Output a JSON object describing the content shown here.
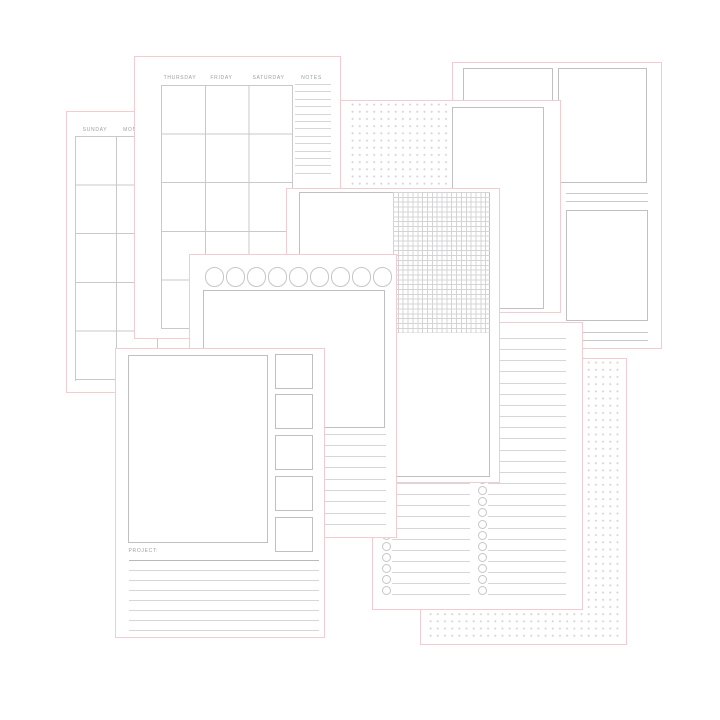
{
  "colors": {
    "pink": "#f4cbd1",
    "grid": "#c9c9cd",
    "gridlite": "#d4d4d7",
    "box": "#bfbfc4",
    "rule": "#d6d6d9",
    "ruleDark": "#b9b9bd",
    "text": "#9ca0a5",
    "dot": "#d8d3d5",
    "circle": "#c6c6ca"
  },
  "sheets": {
    "sunday_month": {
      "day_headers": [
        "SUNDAY",
        "MONDAY"
      ],
      "row_count": 5
    },
    "weekday_month": {
      "day_headers": [
        "THURSDAY",
        "FRIDAY",
        "SATURDAY"
      ],
      "notes_header": "NOTES",
      "notes_line_count": 13,
      "row_count": 5
    },
    "boxes_notes": {
      "box_count": 3,
      "divider_line_count": 2
    },
    "dot_grid_top": {
      "dot_pitch_px": 7.2
    },
    "graph_notes": {
      "grid_pitch_px": 4.85
    },
    "circle_strip": {
      "circle_count": 9,
      "line_count": 9
    },
    "project": {
      "label": "PROJECT:",
      "side_box_count": 5,
      "line_count": 7
    },
    "checklist": {
      "row_count": 24,
      "columns": 2
    },
    "dot_grid_bottom": {
      "dot_pitch_px": 7.2
    }
  }
}
